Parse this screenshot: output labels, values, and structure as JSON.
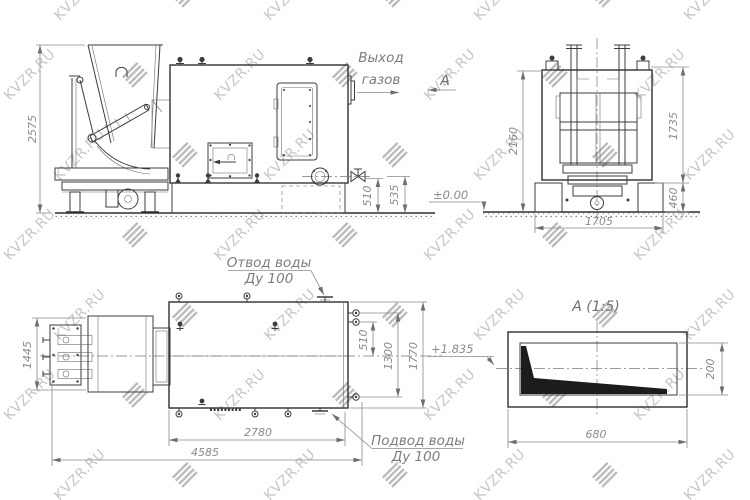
{
  "watermark": {
    "text": "KVZR.RU"
  },
  "drawing": {
    "side_view": {
      "dim_height": "2575",
      "dim_510": "510",
      "dim_535": "535",
      "gas_outlet_line1": "Выход",
      "gas_outlet_line2": "газов",
      "view_label": "А",
      "elevation": "±0.00"
    },
    "front_view": {
      "dim_2160": "2160",
      "dim_1735": "1735",
      "dim_460": "460",
      "dim_1705": "1705"
    },
    "plan_view": {
      "dim_1445": "1445",
      "dim_2780": "2780",
      "dim_4585": "4585",
      "dim_510": "510",
      "dim_1300": "1300",
      "dim_1770": "1770",
      "elevation": "+1.835",
      "water_outlet_line1": "Отвод воды",
      "water_outlet_line2": "Ду 100",
      "water_inlet_line1": "Подвод воды",
      "water_inlet_line2": "Ду 100"
    },
    "section_view": {
      "title": "А  (1:5)",
      "dim_680": "680",
      "dim_200": "200"
    }
  }
}
